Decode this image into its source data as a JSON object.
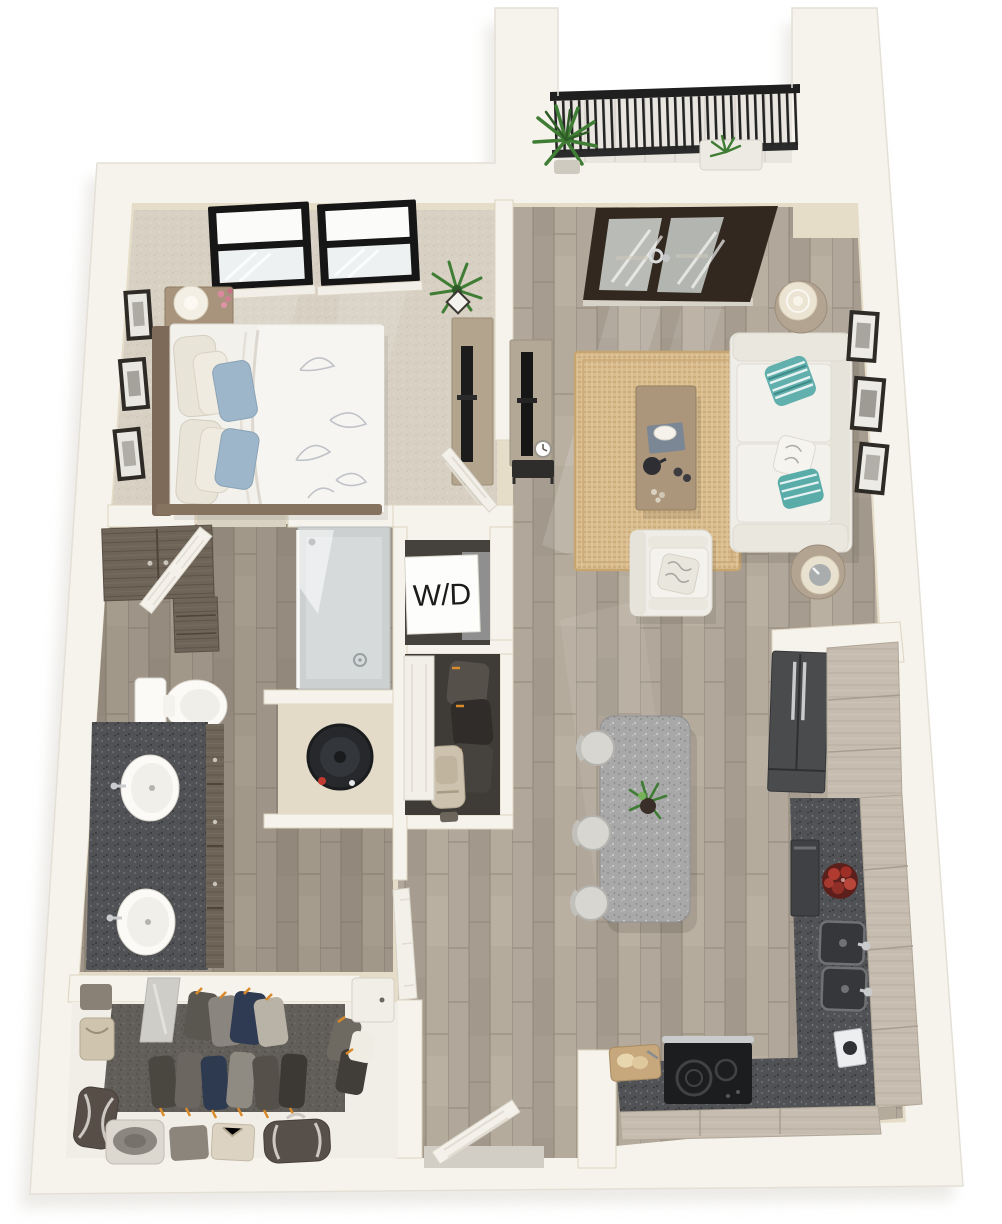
{
  "floorplan": {
    "labels": {
      "washer_dryer": "W/D"
    },
    "rooms": [
      "balcony",
      "bedroom",
      "living-room",
      "kitchen",
      "bathroom",
      "walk-in-closet",
      "coat-closet",
      "laundry-closet",
      "water-heater-closet",
      "hallway",
      "entry"
    ],
    "objects": [
      "bed",
      "nightstand",
      "table-lamp",
      "wall-art",
      "skylight-window",
      "tv-dresser",
      "potted-plant",
      "french-doors",
      "sofa",
      "accent-pillows",
      "coffee-table",
      "armchair",
      "side-table",
      "media-console",
      "area-rug",
      "kitchen-island",
      "bar-stool",
      "refrigerator",
      "double-sink",
      "fruit-bowl",
      "range-cooktop",
      "cutting-board",
      "toilet",
      "double-vanity",
      "walk-in-shower",
      "water-heater",
      "washer-dryer",
      "hanging-clothes",
      "duffel-bag",
      "hat-box",
      "balcony-railing",
      "entry-door"
    ],
    "palette": {
      "wall": "#f6f3ec",
      "wallFace": "#e6ddc9",
      "wood": "#aba195",
      "woodDark": "#978d80",
      "carpet": "#d7d0c3",
      "carpetDark": "#625e59",
      "granite": "#505255",
      "graniteLight": "#a8a8a8",
      "cabinet": "#c6bdb0",
      "cabinetDark": "#6f6458",
      "rug": "#d9bc8e",
      "sofa": "#efede7",
      "teal": "#62b0ad",
      "blue": "#9db6c9",
      "railing": "#1f1f1f",
      "plant": "#3f7c34",
      "apple": "#b03a30",
      "frameDark": "#2e2a26",
      "doorWood": "#33281f"
    }
  }
}
